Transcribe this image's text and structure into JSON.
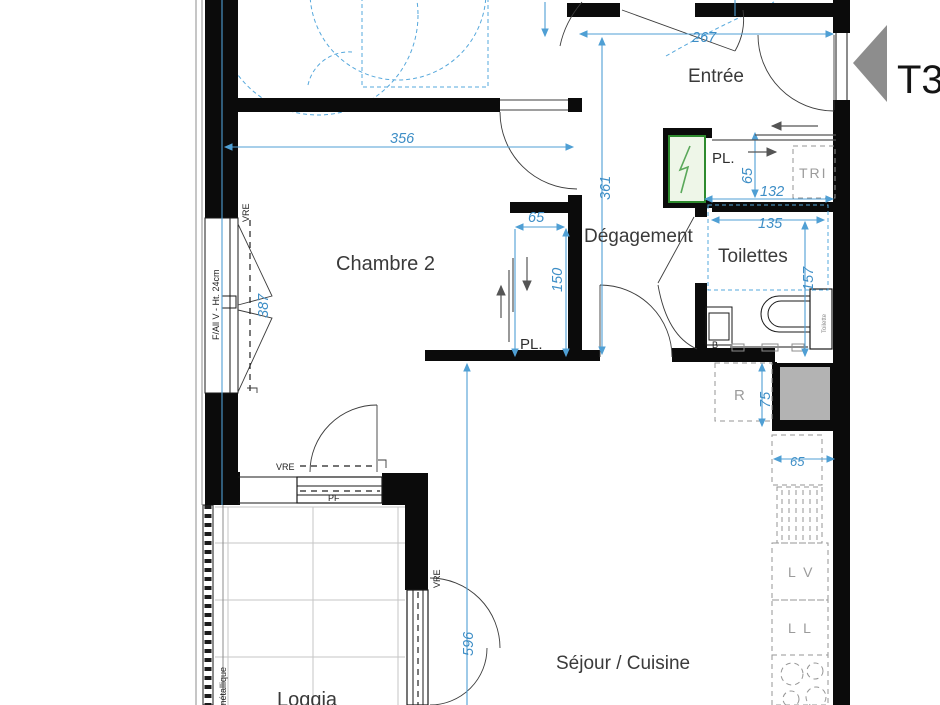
{
  "plan": {
    "type_label": "T3",
    "rooms": {
      "entree": "Entrée",
      "chambre2": "Chambre 2",
      "degagement": "Dégagement",
      "toilettes": "Toilettes",
      "sejour": "Séjour / Cuisine",
      "loggia": "Loggia"
    },
    "dims": {
      "d267": "267",
      "d356": "356",
      "d361": "361",
      "d387": "387",
      "d65_chambre": "65",
      "d150": "150",
      "d65_entree": "65",
      "d132": "132",
      "d135": "135",
      "d157": "157",
      "d75": "75",
      "d65_kitchen": "65",
      "d596": "596"
    },
    "labels": {
      "pl_entree": "PL.",
      "pl_chambre": "PL.",
      "tri": "TRI",
      "r": "R",
      "lv": "L V",
      "ll": "L L",
      "vre_window": "VRE",
      "vre_pf": "VRE",
      "vre_loggia": "VRE",
      "pf": "PF",
      "window_spec": "F/All V - Ht. 24cm",
      "cistern": "Toilette",
      "railing": "métallique",
      "basin": "B"
    },
    "colors": {
      "dimension_blue": "#4f9fd4",
      "wall_black": "#0b0b0b",
      "grey_label": "#9b9b9b",
      "panel_green": "#2e8b2e",
      "duct_grey": "#b3b3b3",
      "arrow_grey": "#8d8d8d"
    }
  }
}
